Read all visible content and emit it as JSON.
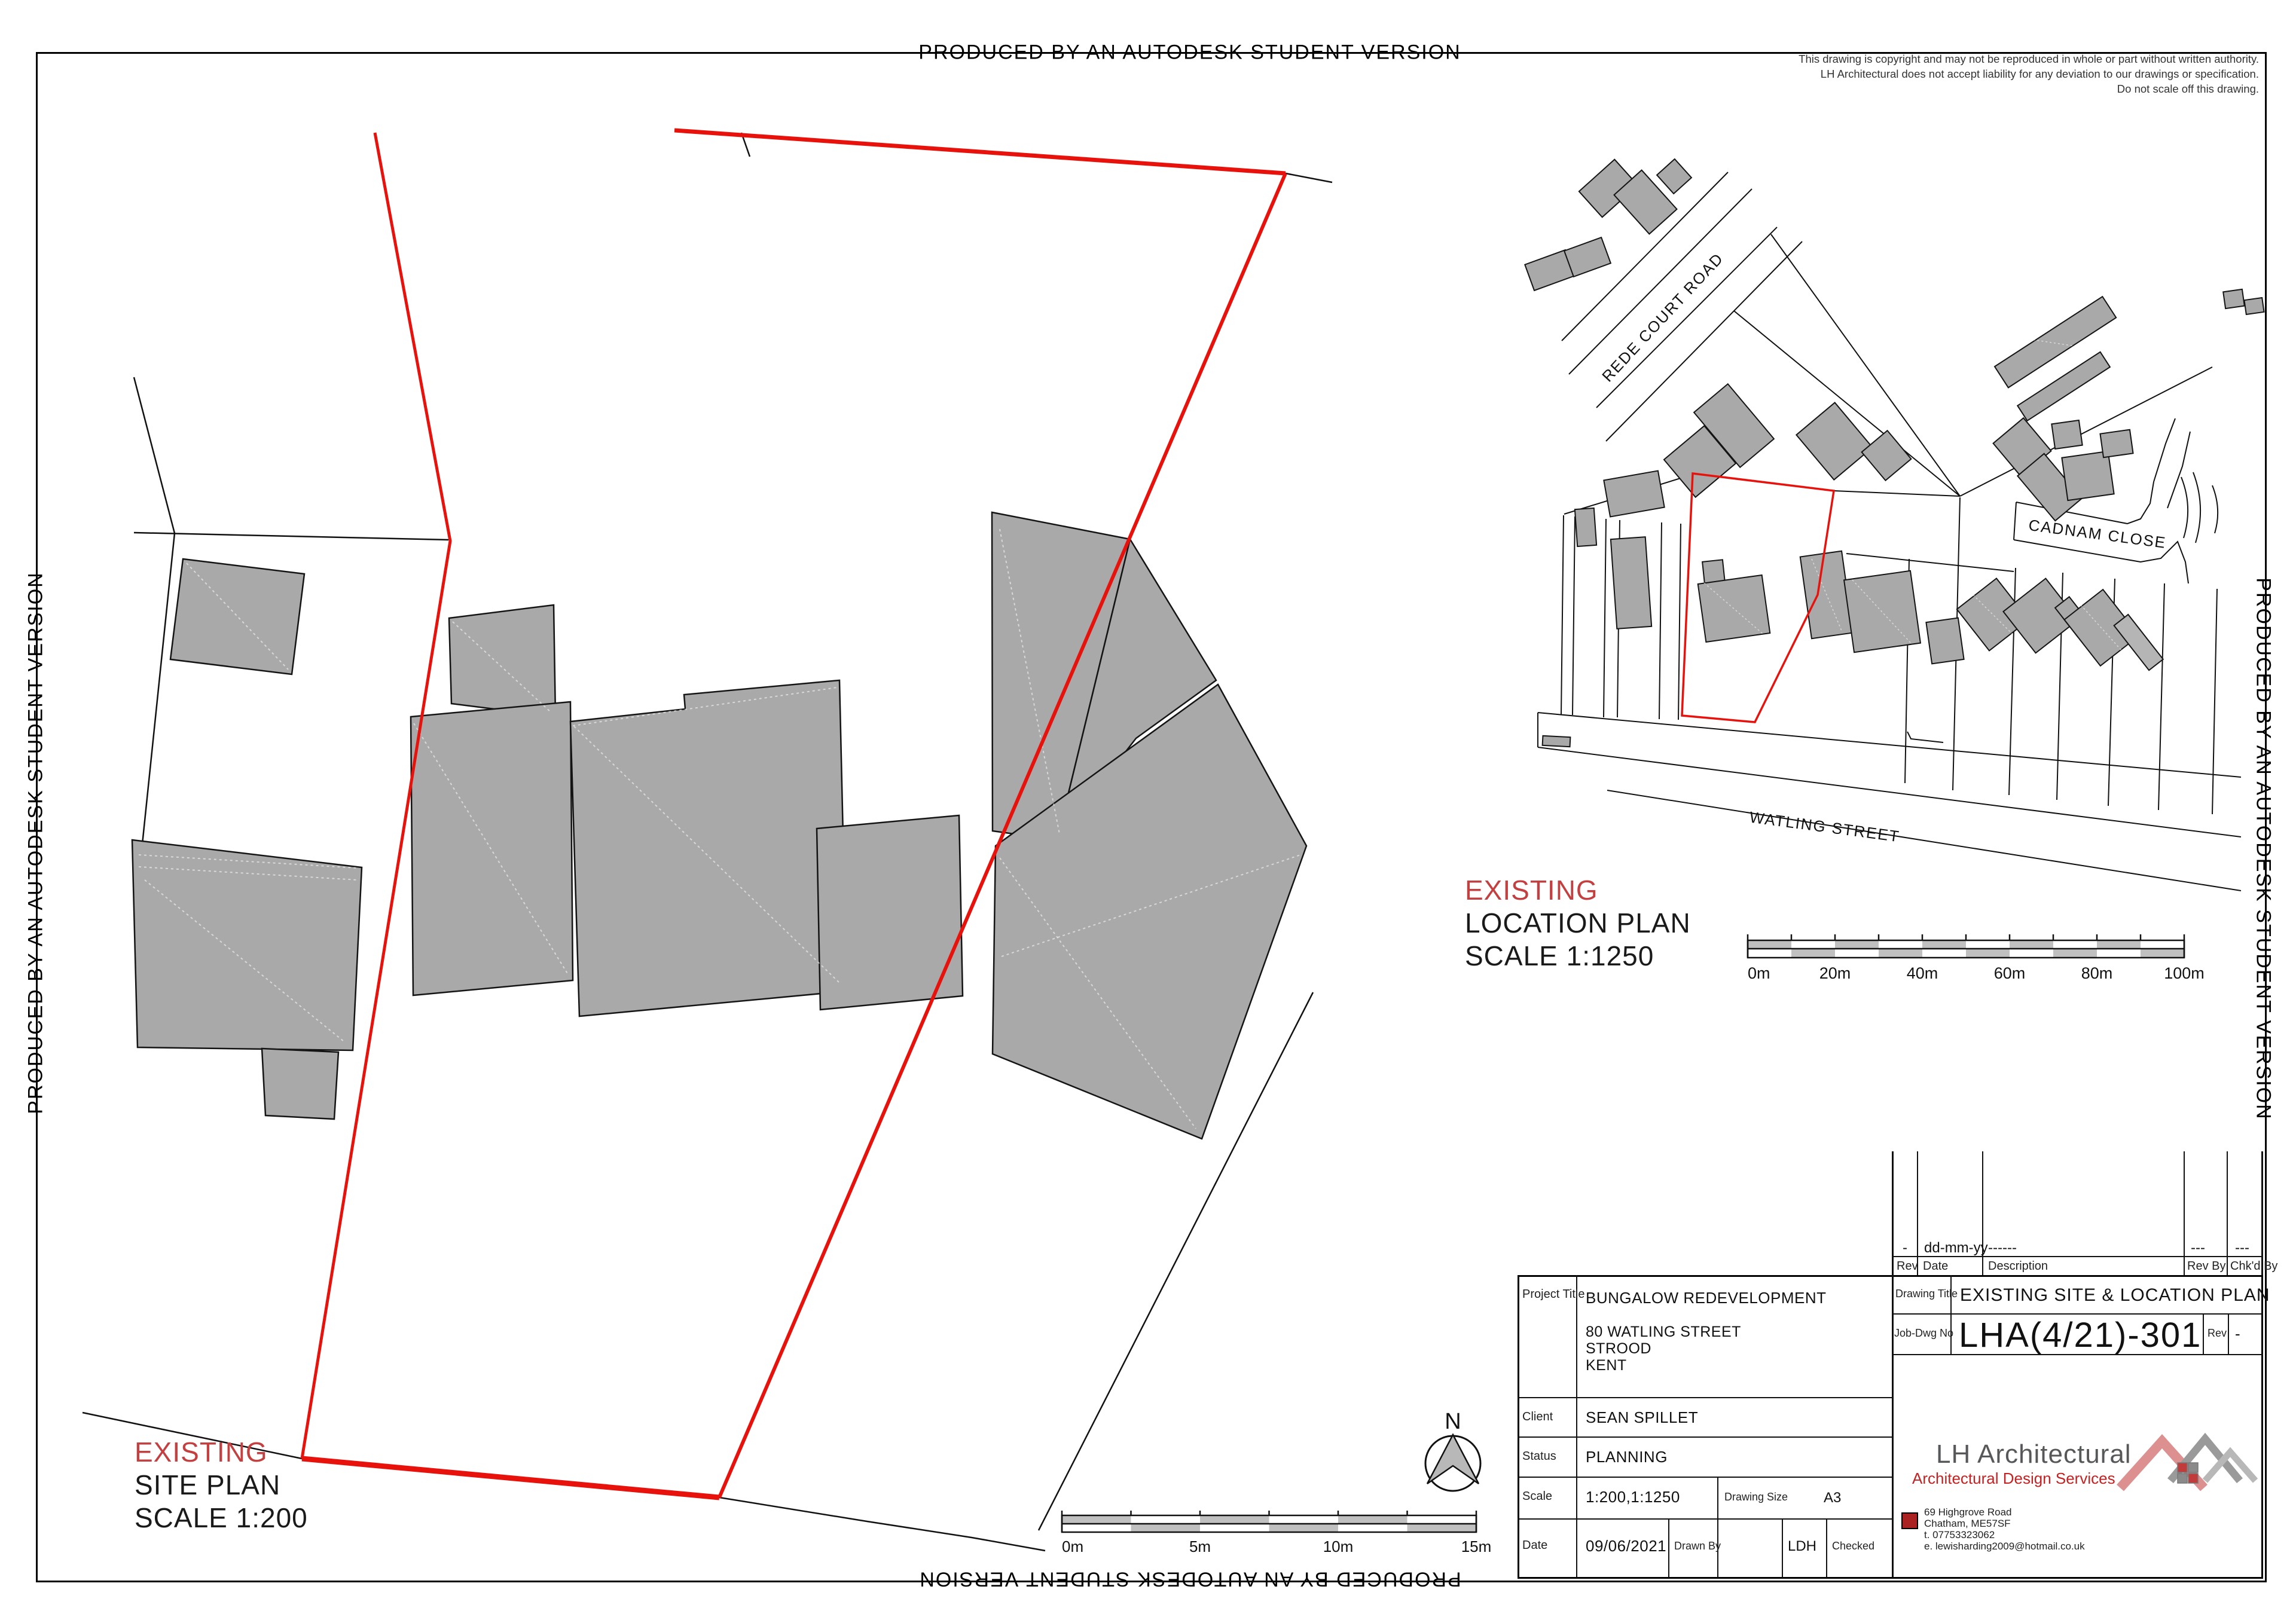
{
  "page": {
    "watermark": "PRODUCED BY AN AUTODESK STUDENT VERSION",
    "copyright_lines": [
      "This drawing is copyright and may not be reproduced in whole or part without written authority.",
      "LH Architectural does not accept liability for any deviation to our drawings or specification.",
      "Do not scale off this drawing."
    ]
  },
  "site_plan": {
    "existing": "EXISTING",
    "title": "SITE PLAN",
    "scale": "SCALE 1:200",
    "north": "N",
    "scale_bar": {
      "labels": [
        "0m",
        "5m",
        "10m",
        "15m"
      ]
    }
  },
  "location_plan": {
    "existing": "EXISTING",
    "title": "LOCATION PLAN",
    "scale": "SCALE 1:1250",
    "streets": {
      "rede": "REDE COURT ROAD",
      "cadnam": "CADNAM CLOSE",
      "watling": "WATLING STREET"
    },
    "scale_bar": {
      "labels": [
        "0m",
        "20m",
        "40m",
        "60m",
        "80m",
        "100m"
      ]
    }
  },
  "title_block": {
    "revision": {
      "headers": [
        "Rev",
        "Date",
        "Description",
        "Rev By",
        "Chk'd By"
      ],
      "row": [
        "-",
        "dd-mm-yy",
        "------",
        "---",
        "---"
      ]
    },
    "project_title_label": "Project Title",
    "project_title": "BUNGALOW REDEVELOPMENT",
    "address": [
      "80 WATLING STREET",
      "STROOD",
      "KENT"
    ],
    "client_label": "Client",
    "client": "SEAN SPILLET",
    "status_label": "Status",
    "status": "PLANNING",
    "scale_label": "Scale",
    "scale": "1:200,1:1250",
    "drawing_size_label": "Drawing Size",
    "drawing_size": "A3",
    "date_label": "Date",
    "date": "09/06/2021",
    "drawn_by_label": "Drawn By",
    "drawn_by": "LDH",
    "checked_label": "Checked",
    "drawing_title_label": "Drawing Title",
    "drawing_title": "EXISTING SITE & LOCATION PLAN",
    "job_dwg_label": "Job-Dwg No",
    "job_dwg": "LHA(4/21)-301",
    "rev_label": "Rev",
    "rev_value": "-",
    "firm": {
      "name": "LH Architectural",
      "tagline": "Architectural Design Services",
      "address": [
        "69 Highgrove Road",
        "Chatham, ME57SF",
        "t.  07753323062",
        "e. lewisharding2009@hotmail.co.uk"
      ]
    }
  },
  "colors": {
    "boundary_red": "#e8120c",
    "label_red": "#c43f3f",
    "building_fill": "#a9a9a9",
    "tagline_red": "#c42222",
    "firm_gray": "#57585a"
  }
}
